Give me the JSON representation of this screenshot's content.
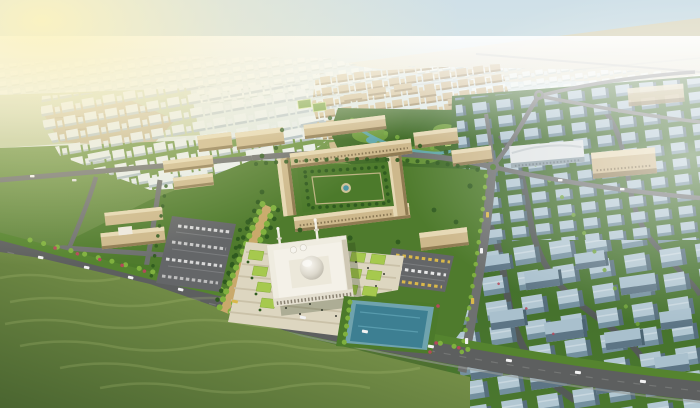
{
  "scene": {
    "description": "Aerial rendering of a desert city masterplan: central campus quadrangle, grand mosque with dome and minarets on a striped plaza, reflecting pool, palm promenade, parking lots, tan and white residential districts, blue-gray apartment district, main boulevard and foreground grass field under hazy warm light",
    "landmarks": [
      "distant-city",
      "white-residential-district",
      "tan-residential-district",
      "central-park-lake",
      "campus-quadrangle",
      "grand-mosque",
      "ceremonial-plaza",
      "reflecting-pool",
      "blue-residential-district",
      "main-boulevard",
      "palm-promenade",
      "parking-lots",
      "roundabouts",
      "grass-field"
    ]
  },
  "colors": {
    "sky_top": "#cfe0e8",
    "sky_mid": "#e9eee2",
    "sky_low": "#f4f0da",
    "sky_base": "#f7f3de",
    "sun_glow": "#fcf3c0",
    "desert": "#e6dcc0",
    "haze": "#ffffff",
    "distant_block": "#eff4f0",
    "distant_shadow": "#c2cfc9",
    "white_block": "#e9efef",
    "white_block_side": "#b5c3c9",
    "tan_block": "#cdb88c",
    "tan_block_side": "#9e8960",
    "tan_roof_light": "#e6d8b4",
    "blue_roof": "#b2c7d2",
    "blue_front": "#74909f",
    "blue_side": "#566e7c",
    "grass_dark": "#3f6b26",
    "grass_mid": "#55842f",
    "grass_bright": "#74a23e",
    "lawn": "#a6c94e",
    "ground_top": "#719748",
    "ground_bottom": "#47692c",
    "field_light": "#90a957",
    "field_dark": "#4a6530",
    "field_ripple": "#b6c77e",
    "road": "#5d5f5f",
    "road_mid": "#6e7070",
    "road_light": "#8a8c8a",
    "parking": "#646668",
    "plaza": "#ddd6c0",
    "plaza_stripe": "#c8bfa6",
    "mosque": "#efece0",
    "mosque_shade": "#cfc8b4",
    "dome_hi": "#faf8f2",
    "dome_mid": "#ddd9cd",
    "dome_dark": "#b7b2a5",
    "pool": "#3d7f92",
    "pool_deck": "#6fa3ae",
    "stream": "#5fa7ad",
    "tree_dark": "#2f5a1f",
    "tree_bright": "#7fb13e",
    "shrub_red": "#b5485a",
    "walkway": "#c9a96b",
    "car_white": "#f2f2f2",
    "car_yellow": "#d9b84a"
  }
}
